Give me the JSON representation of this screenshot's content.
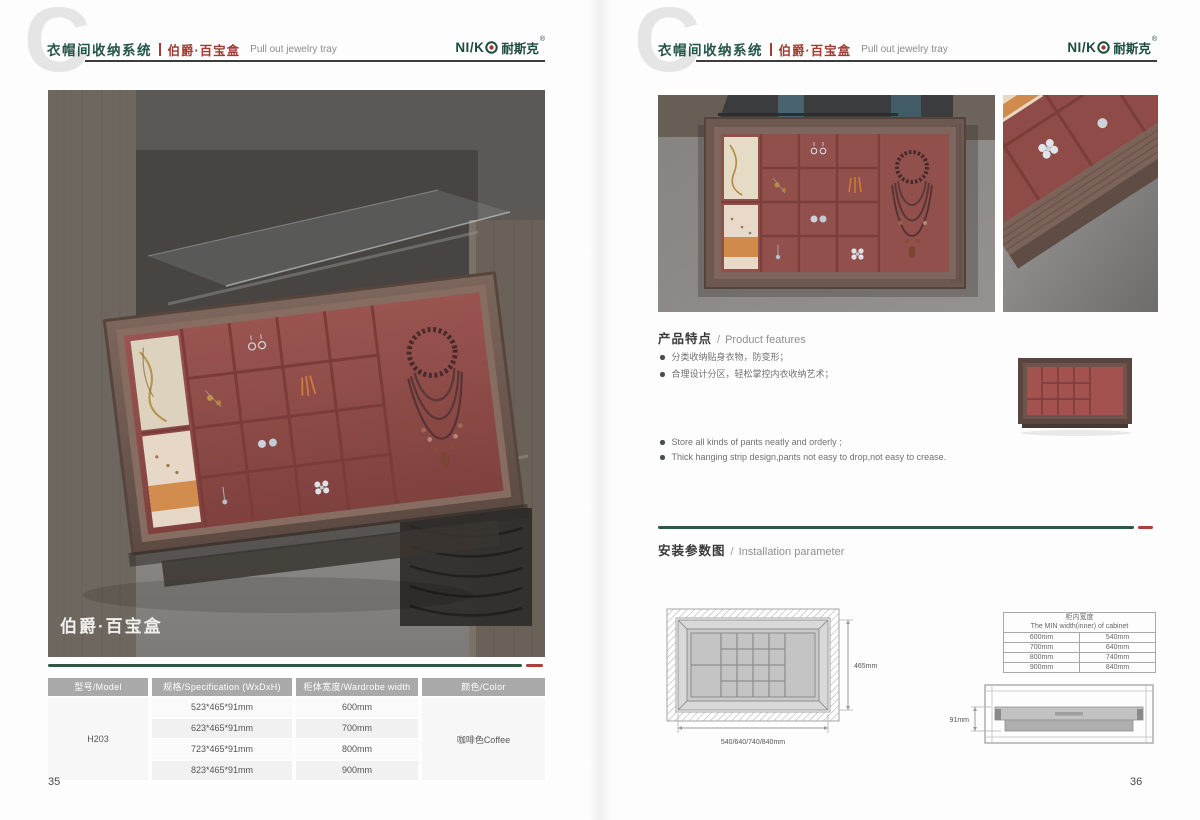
{
  "header": {
    "big_letter": "C",
    "title_cn": "衣帽间收纳系统",
    "product_cn": "伯爵·百宝盒",
    "product_en": "Pull out jewelry tray",
    "logo": {
      "latin": "NI/K",
      "cn": "耐斯克",
      "reg": "®"
    }
  },
  "left_page": {
    "page_number": "35",
    "photo_label": "伯爵·百宝盒",
    "table": {
      "headers": [
        "型号/Model",
        "规格/Specification (WxDxH)",
        "柜体宽度/Wardrobe width",
        "颜色/Color"
      ],
      "model": "H203",
      "rows": [
        {
          "spec": "523*465*91mm",
          "width": "600mm"
        },
        {
          "spec": "623*465*91mm",
          "width": "700mm"
        },
        {
          "spec": "723*465*91mm",
          "width": "800mm"
        },
        {
          "spec": "823*465*91mm",
          "width": "900mm"
        }
      ],
      "color": "咖啡色Coffee"
    }
  },
  "right_page": {
    "page_number": "36",
    "features": {
      "title_cn": "产品特点",
      "sep": "/",
      "title_en": "Product features",
      "bullets_cn": [
        "分类收纳贴身衣物，防变形；",
        "合理设计分区，轻松掌控内衣收纳艺术；"
      ],
      "bullets_en": [
        "Store all kinds of pants neatly and orderly ;",
        "Thick hanging strip design,pants not easy to drop,not easy to crease."
      ]
    },
    "installation": {
      "title_cn": "安装参数图",
      "sep": "/",
      "title_en": "Installation parameter",
      "top_view": {
        "depth": "465mm",
        "widths": "540/640/740/840mm"
      },
      "side_view": {
        "height": "91mm"
      },
      "cabinet_table": {
        "title_cn": "柜内宽度",
        "title_en": "The MIN width(inner) of cabinet",
        "rows": [
          [
            "600mm",
            "540mm"
          ],
          [
            "700mm",
            "640mm"
          ],
          [
            "800mm",
            "740mm"
          ],
          [
            "900mm",
            "840mm"
          ]
        ]
      }
    }
  },
  "colors": {
    "brand_green": "#1e4f41",
    "accent_red": "#ad3f36",
    "velvet": "#92504d",
    "table_header_gray": "#a9a9a9"
  }
}
